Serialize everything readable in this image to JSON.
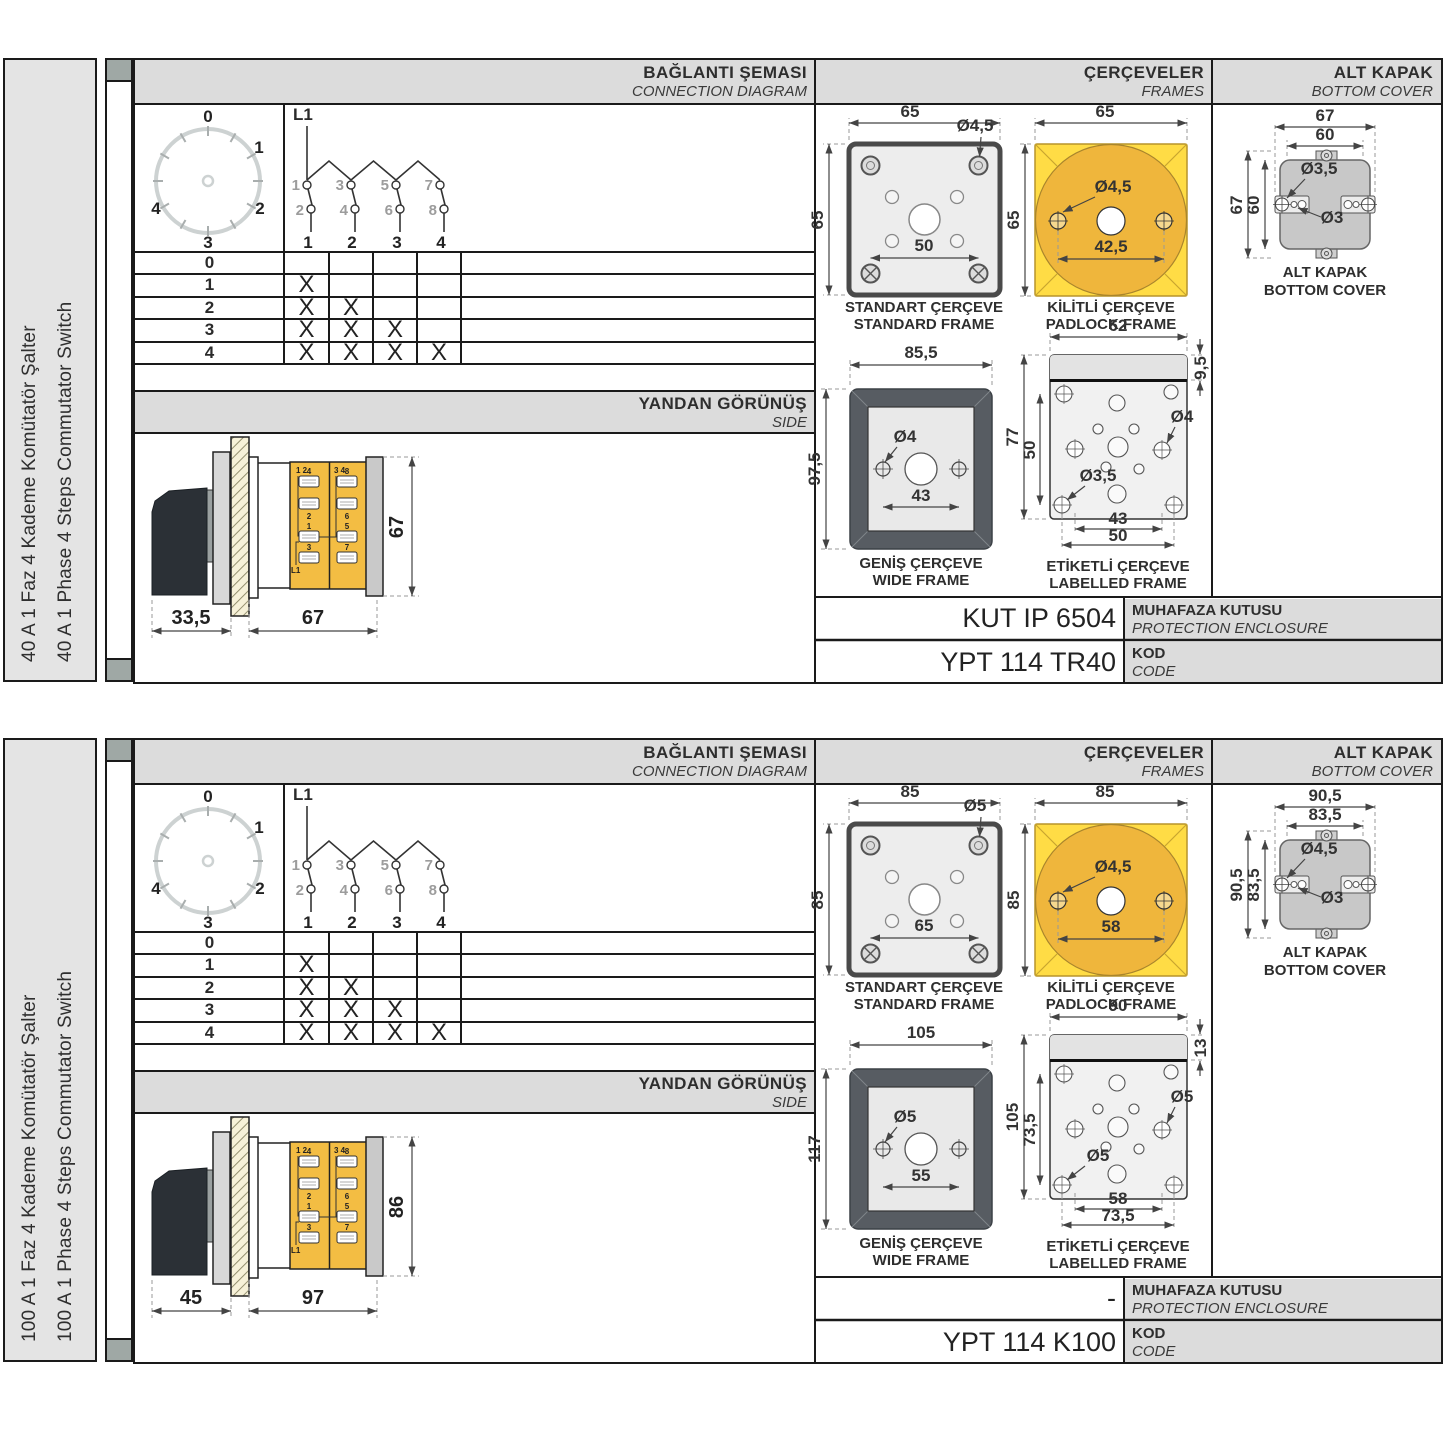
{
  "sections": [
    {
      "sidebar": {
        "tr": "40 A 1 Faz 4 Kademe Komütatör Şalter",
        "en": "40 A 1 Phase 4 Steps Commutator Switch"
      },
      "headers": {
        "connection_tr": "BAĞLANTI ŞEMASI",
        "connection_en": "CONNECTION DIAGRAM",
        "frames_tr": "ÇERÇEVELER",
        "frames_en": "FRAMES",
        "cover_tr": "ALT KAPAK",
        "cover_en": "BOTTOM COVER"
      },
      "dial": {
        "l0": "0",
        "l1": "1",
        "l2": "2",
        "l3": "3",
        "l4": "4"
      },
      "diagram": {
        "feed": "L1",
        "t1": "1",
        "t2": "2",
        "t3": "3",
        "t4": "4",
        "t5": "5",
        "t6": "6",
        "t7": "7",
        "t8": "8",
        "p1": "1",
        "p2": "2",
        "p3": "3",
        "p4": "4"
      },
      "table": {
        "rows": [
          {
            "step": "0",
            "c": [
              "",
              "",
              "",
              ""
            ]
          },
          {
            "step": "1",
            "c": [
              "X",
              "",
              "",
              ""
            ]
          },
          {
            "step": "2",
            "c": [
              "X",
              "X",
              "",
              ""
            ]
          },
          {
            "step": "3",
            "c": [
              "X",
              "X",
              "X",
              ""
            ]
          },
          {
            "step": "4",
            "c": [
              "X",
              "X",
              "X",
              "X"
            ]
          }
        ]
      },
      "side": {
        "band_tr": "YANDAN GÖRÜNÜŞ",
        "band_en": "SIDE",
        "dim_handle": "33,5",
        "dim_body": "67",
        "dim_height": "67",
        "feed": "L1",
        "corner_l": "1 2",
        "corner_r": "3 4",
        "tl": [
          "4",
          "8",
          "2",
          "6",
          "1",
          "5",
          "3",
          "7"
        ]
      },
      "standard": {
        "t1": "STANDART ÇERÇEVE",
        "t2": "STANDARD FRAME",
        "w": "65",
        "h": "65",
        "inner": "50",
        "hole": "Ø4,5"
      },
      "padlock": {
        "t1": "KİLİTLİ ÇERÇEVE",
        "t2": "PADLOCK FRAME",
        "w": "65",
        "h": "65",
        "inner": "42,5",
        "hole": "Ø4,5"
      },
      "wide": {
        "t1": "GENİŞ ÇERÇEVE",
        "t2": "WIDE FRAME",
        "w": "85,5",
        "h": "97,5",
        "inner": "43",
        "hole": "Ø4"
      },
      "labelled": {
        "t1": "ETİKETLİ ÇERÇEVE",
        "t2": "LABELLED FRAME",
        "w": "62",
        "band": "9,5",
        "h": "77",
        "hv": "50",
        "hole_r": "Ø4",
        "hole_b": "Ø3,5",
        "b1": "43",
        "b2": "50"
      },
      "cover": {
        "t1": "ALT KAPAK",
        "t2": "BOTTOM COVER",
        "w1": "67",
        "w2": "60",
        "h1": "67",
        "h2": "60",
        "hole1": "Ø3,5",
        "hole2": "Ø3"
      },
      "codes": {
        "enclosure": "KUT IP 6504",
        "enclosure_tr": "MUHAFAZA KUTUSU",
        "enclosure_en": "PROTECTION ENCLOSURE",
        "code": "YPT 114 TR40",
        "kod_tr": "KOD",
        "kod_en": "CODE"
      }
    },
    {
      "sidebar": {
        "tr": "100 A 1 Faz 4 Kademe Komütatör Şalter",
        "en": "100 A 1 Phase 4 Steps Commutator Switch"
      },
      "headers": {
        "connection_tr": "BAĞLANTI ŞEMASI",
        "connection_en": "CONNECTION DIAGRAM",
        "frames_tr": "ÇERÇEVELER",
        "frames_en": "FRAMES",
        "cover_tr": "ALT KAPAK",
        "cover_en": "BOTTOM COVER"
      },
      "dial": {
        "l0": "0",
        "l1": "1",
        "l2": "2",
        "l3": "3",
        "l4": "4"
      },
      "diagram": {
        "feed": "L1",
        "t1": "1",
        "t2": "2",
        "t3": "3",
        "t4": "4",
        "t5": "5",
        "t6": "6",
        "t7": "7",
        "t8": "8",
        "p1": "1",
        "p2": "2",
        "p3": "3",
        "p4": "4"
      },
      "table": {
        "rows": [
          {
            "step": "0",
            "c": [
              "",
              "",
              "",
              ""
            ]
          },
          {
            "step": "1",
            "c": [
              "X",
              "",
              "",
              ""
            ]
          },
          {
            "step": "2",
            "c": [
              "X",
              "X",
              "",
              ""
            ]
          },
          {
            "step": "3",
            "c": [
              "X",
              "X",
              "X",
              ""
            ]
          },
          {
            "step": "4",
            "c": [
              "X",
              "X",
              "X",
              "X"
            ]
          }
        ]
      },
      "side": {
        "band_tr": "YANDAN GÖRÜNÜŞ",
        "band_en": "SIDE",
        "dim_handle": "45",
        "dim_body": "97",
        "dim_height": "86",
        "feed": "L1",
        "corner_l": "1 2",
        "corner_r": "3 4",
        "tl": [
          "4",
          "8",
          "2",
          "6",
          "1",
          "5",
          "3",
          "7"
        ]
      },
      "standard": {
        "t1": "STANDART ÇERÇEVE",
        "t2": "STANDARD FRAME",
        "w": "85",
        "h": "85",
        "inner": "65",
        "hole": "Ø5"
      },
      "padlock": {
        "t1": "KİLİTLİ ÇERÇEVE",
        "t2": "PADLOCK FRAME",
        "w": "85",
        "h": "85",
        "inner": "58",
        "hole": "Ø4,5"
      },
      "wide": {
        "t1": "GENİŞ ÇERÇEVE",
        "t2": "WIDE FRAME",
        "w": "105",
        "h": "117",
        "inner": "55",
        "hole": "Ø5"
      },
      "labelled": {
        "t1": "ETİKETLİ ÇERÇEVE",
        "t2": "LABELLED FRAME",
        "w": "90",
        "band": "13",
        "h": "105",
        "hv": "73,5",
        "hole_r": "Ø5",
        "hole_b": "Ø5",
        "b1": "58",
        "b2": "73,5"
      },
      "cover": {
        "t1": "ALT KAPAK",
        "t2": "BOTTOM COVER",
        "w1": "90,5",
        "w2": "83,5",
        "h1": "90,5",
        "h2": "83,5",
        "hole1": "Ø4,5",
        "hole2": "Ø3"
      },
      "codes": {
        "enclosure": "-",
        "enclosure_tr": "MUHAFAZA KUTUSU",
        "enclosure_en": "PROTECTION ENCLOSURE",
        "code": "YPT 114 K100",
        "kod_tr": "KOD",
        "kod_en": "CODE"
      }
    }
  ]
}
